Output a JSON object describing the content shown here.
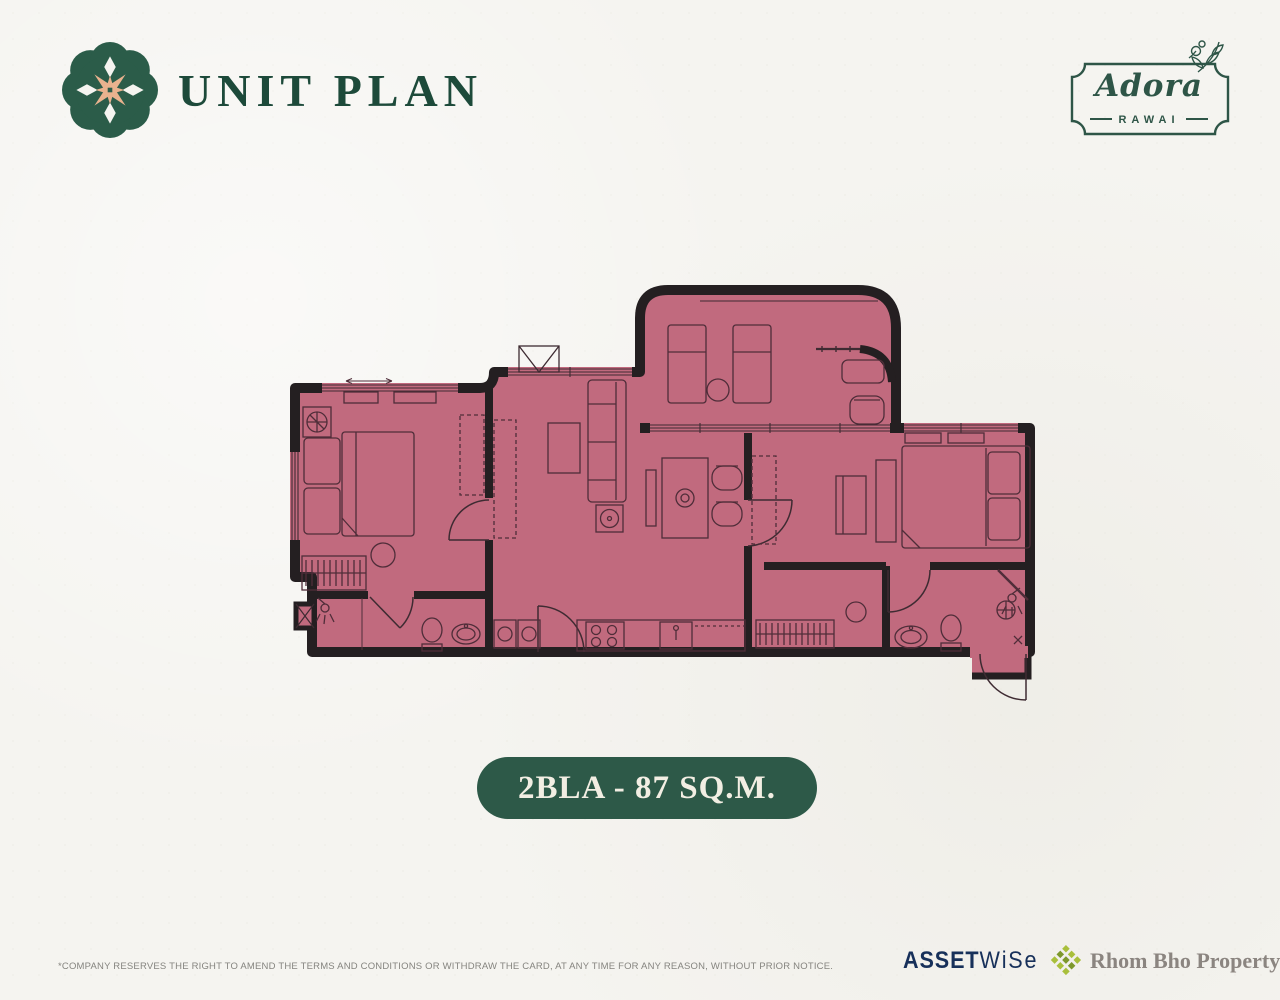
{
  "page": {
    "background_color": "#f5f4f0"
  },
  "header": {
    "title": "UNIT PLAN",
    "logo": {
      "icon": "medallion-flower-icon",
      "color": "#2b5c49",
      "accent_color": "#e9b28e"
    }
  },
  "project_badge": {
    "name": "Adora",
    "subtitle": "RAWAI",
    "border_color": "#2e5547",
    "icon": "botanical-sprig-icon"
  },
  "unit_badge": {
    "label": "2BLA - 87 SQ.M.",
    "background_color": "#2d5948",
    "text_color": "#f2eee3"
  },
  "floor_plan": {
    "fill_color": "#c16a7e",
    "wall_color": "#241f21",
    "furniture_line_color": "#4f2d39",
    "text_labels": []
  },
  "footer": {
    "disclaimer": "*COMPANY RESERVES THE RIGHT TO AMEND THE TERMS AND CONDITIONS OR WITHDRAW THE CARD, AT ANY TIME FOR ANY REASON, WITHOUT PRIOR NOTICE.",
    "assetwise_logo": {
      "part1": "ASSET",
      "part2": "WiSe",
      "color": "#17305a"
    },
    "partner_logo": {
      "name": "Rhom Bho Property",
      "color": "#8b8580",
      "icon": "diamond-cluster-icon",
      "icon_color": "#a9bf3b"
    }
  }
}
